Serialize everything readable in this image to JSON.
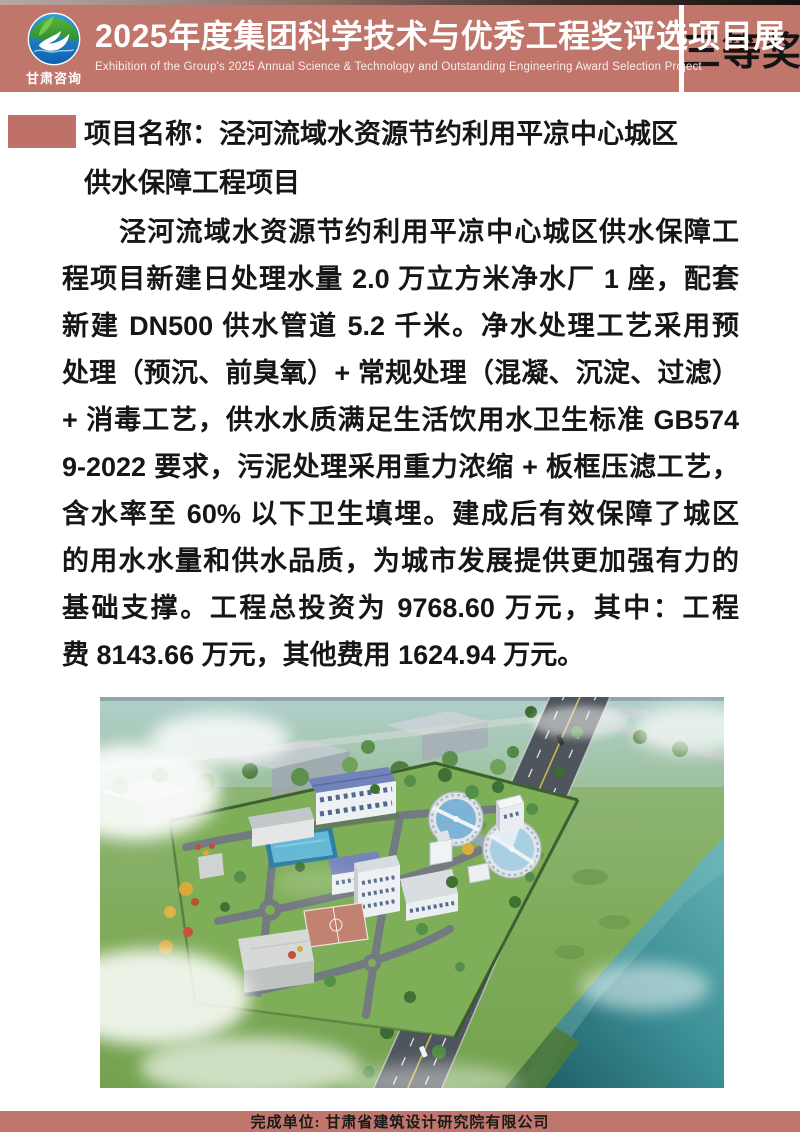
{
  "theme": {
    "header_bg": "#c1766c",
    "accent_block": "#bf7169",
    "footer_bg": "#c1766c",
    "award_text": "#141414",
    "body_text": "#161616"
  },
  "header": {
    "logo_text": "甘肃咨询",
    "logo_icon": "swan-leaf-wave-logo",
    "title": "2025年度集团科学技术与优秀工程奖评选项目展",
    "subtitle": "Exhibition of the Group's 2025 Annual Science & Technology and Outstanding Engineering Award Selection Project",
    "award_badge": "三等奖"
  },
  "content": {
    "project_name_line1": "项目名称：泾河流域水资源节约利用平凉中心城区",
    "project_name_line2": "供水保障工程项目",
    "paragraph_lines": [
      "泾河流域水资源节约利用平凉中心城区供水保障工",
      "程项目新建日处理水量 2.0 万立方米净水厂 1 座，配套",
      "新建 DN500 供水管道 5.2 千米。净水处理工艺采用预",
      "处理（预沉、前臭氧）+ 常规处理（混凝、沉淀、过滤）",
      "+ 消毒工艺，供水水质满足生活饮用水卫生标准 GB574",
      "9-2022 要求，污泥处理采用重力浓缩 + 板框压滤工艺，",
      "含水率至 60% 以下卫生填埋。建成后有效保障了城区",
      "的用水水量和供水品质，为城市发展提供更加强有力的",
      "基础支撑。工程总投资为 9768.60 万元，其中：工程",
      "费 8143.66 万元，其他费用 1624.94 万元。"
    ],
    "paragraph_full": "泾河流域水资源节约利用平凉中心城区供水保障工程项目新建日处理水量 2.0 万立方米净水厂 1 座，配套新建 DN500 供水管道 5.2 千米。净水处理工艺采用预处理（预沉、前臭氧）+ 常规处理（混凝、沉淀、过滤）+ 消毒工艺，供水水质满足生活饮用水卫生标准 GB5749-2022 要求，污泥处理采用重力浓缩 + 板框压滤工艺，含水率至 60% 以下卫生填埋。建成后有效保障了城区的用水水量和供水品质，为城市发展提供更加强有力的基础支撑。工程总投资为 9768.60 万元，其中：工程费 8143.66 万元，其他费用 1624.94 万元。",
    "image_description": "aerial rendering of the Pingliang central urban water supply treatment plant"
  },
  "footer": {
    "completed_by": "完成单位: 甘肃省建筑设计研究院有限公司"
  }
}
